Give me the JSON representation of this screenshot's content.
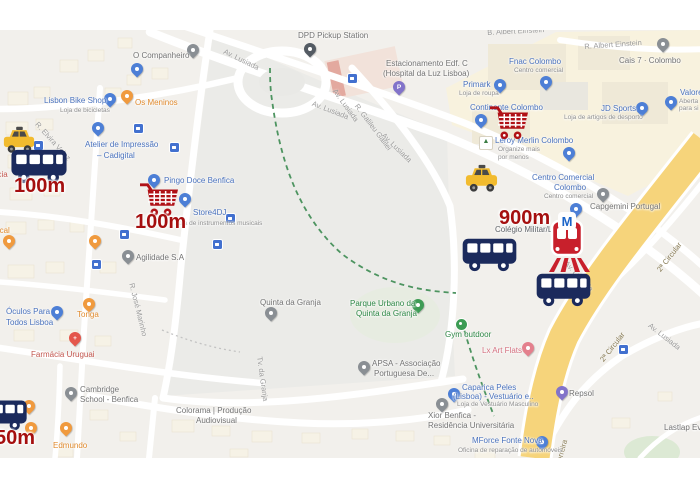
{
  "overlays": {
    "distances": {
      "d1": "100m",
      "d2": "100m",
      "d3": "900m",
      "d4": "50m"
    }
  },
  "road_labels": {
    "av_lusiada": "Av. Lusiada",
    "r_galileu": "R. Galileu Galilei",
    "r_albert": "R. Albert Einstein",
    "b_albert": "B. Albert Einstein",
    "circular": "2ª Circular",
    "r_elvira": "R. Elvira Velez",
    "r_jose": "R. José Marinho",
    "tv_granja": "Tv. da Granja",
    "ferreira": "a Ferreira"
  },
  "pois": {
    "o_companheiro": {
      "label": "O Companheiro"
    },
    "lisbon_bike": {
      "label": "Lisbon Bike Shop",
      "sub": "Loja de bicicletas"
    },
    "os_meninos": {
      "label": "Os Meninos"
    },
    "atelier": {
      "l1": "Atelier de Impressão",
      "l2": "– Cadigital"
    },
    "pingo_doce": {
      "label": "Pingo Doce Benfica"
    },
    "store4dj": {
      "label": "Store4DJ",
      "sub": "Loja de instrumentos musicais"
    },
    "agilidade": {
      "label": "Agilidade S.A"
    },
    "tropical": {
      "label": "tropical"
    },
    "farmacia_cut": {
      "label": "ácia"
    },
    "oculos": {
      "l1": "Óculos Para",
      "l2": "Todos Lisboa"
    },
    "tonga": {
      "label": "Tonga"
    },
    "farmacia": {
      "label": "Farmácia Uruguai"
    },
    "cambridge": {
      "l1": "Cambridge",
      "l2": "School - Benfica"
    },
    "edmundo": {
      "label": "Edmundo"
    },
    "quinta": {
      "label": "Quinta da Granja"
    },
    "parque": {
      "l1": "Parque Urbano da",
      "l2": "Quinta da Granja"
    },
    "gym": {
      "label": "Gym outdoor"
    },
    "apsa": {
      "l1": "APSA - Associação",
      "l2": "Portuguesa De..."
    },
    "colorama": {
      "l1": "Colorama | Produção",
      "l2": "Audiovisual"
    },
    "dpd": {
      "label": "DPD Pickup Station"
    },
    "estacionamento": {
      "l1": "Estacionamento Edf. C",
      "l2": "(Hospital da Luz Lisboa)"
    },
    "primark": {
      "label": "Primark",
      "sub": "Loja de roupa"
    },
    "fnac": {
      "label": "Fnac Colombo",
      "sub": "Centro comercial"
    },
    "continente": {
      "label": "Continente Colombo"
    },
    "leroy": {
      "label": "Leroy Merlin Colombo",
      "sub1": "Organize mais",
      "sub2": "por menos"
    },
    "jd": {
      "label": "JD Sports",
      "sub": "Loja de artigos de desporto"
    },
    "cais7": {
      "label": "Cais 7 · Colombo"
    },
    "valore": {
      "label": "Valore",
      "sub1": "Aberta",
      "sub2": "para si"
    },
    "centro": {
      "l1": "Centro Comercial",
      "l2": "Colombo",
      "sub": "Centro comercial"
    },
    "capgemini": {
      "label": "Capgemini Portugal"
    },
    "colegio": {
      "label": "Colégio Militar/Lu"
    },
    "caparica": {
      "l1": "Caparica Peles",
      "l2": "(Lisboa) - Vestuário e..",
      "sub": "Loja de Vestuário Masculino"
    },
    "xior": {
      "l1": "Xior Benfica -",
      "l2": "Residência Universitária"
    },
    "mforce": {
      "label": "MForce Fonte Nova",
      "sub": "Oficina de reparação de automóveis"
    },
    "repsol": {
      "label": "Repsol"
    },
    "lastlap": {
      "label": "Lastlap Ev"
    },
    "lx_art": {
      "label": "Lx Art Flats"
    }
  },
  "colors": {
    "bus_navy": "#1b2a5c",
    "overlay_red": "#b01116",
    "distance_red": "#a50f0f",
    "taxi_yellow": "#f2bb2e",
    "metro_red": "#c8202c",
    "metro_m_blue": "#1a63c8",
    "highway_yellow": "#f6d47b",
    "shop_blue": "#4a72bd",
    "restaurant_orange": "#e08a2d",
    "park_green": "#2d8745",
    "pharmacy_red": "#c2564e",
    "lodging_pink": "#d4707f"
  }
}
